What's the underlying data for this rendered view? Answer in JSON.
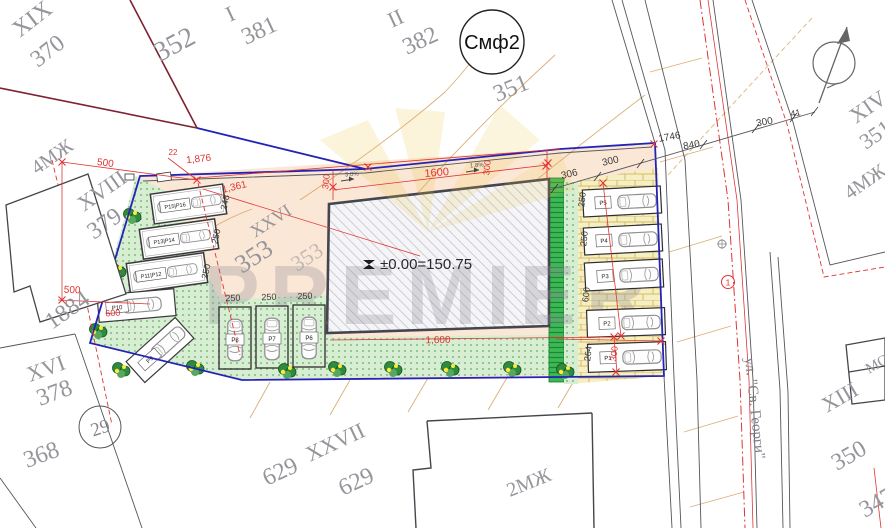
{
  "plan": {
    "building_elevation": "±0.00=150.75",
    "zone_circle": "Смф2",
    "point_circle": "29",
    "street_point": "1",
    "street_name": "ул. \"Св. Георги\"",
    "watermark": "PREMIER"
  },
  "colors": {
    "site_boundary": "#2323b8",
    "dim_red": "#e03434",
    "peach": "#fbe7d5",
    "green_light": "#d7eed2",
    "green_hedge": "#3cb954",
    "brick_bg": "#f6efc4",
    "watermark_gold": "#edc84a"
  },
  "parcel_labels": [
    {
      "t": "XIX",
      "x": 20,
      "y": 38,
      "r": -38,
      "s": 24
    },
    {
      "t": "370",
      "x": 38,
      "y": 68,
      "r": -38,
      "s": 24
    },
    {
      "t": "352",
      "x": 160,
      "y": 62,
      "r": -28,
      "s": 28
    },
    {
      "t": "I",
      "x": 230,
      "y": 22,
      "r": -25,
      "s": 22
    },
    {
      "t": "381",
      "x": 246,
      "y": 45,
      "r": -25,
      "s": 24
    },
    {
      "t": "II",
      "x": 392,
      "y": 28,
      "r": -25,
      "s": 22
    },
    {
      "t": "382",
      "x": 407,
      "y": 55,
      "r": -25,
      "s": 24
    },
    {
      "t": "351",
      "x": 497,
      "y": 102,
      "r": -22,
      "s": 24
    },
    {
      "t": "XIV",
      "x": 856,
      "y": 124,
      "r": -35,
      "s": 22
    },
    {
      "t": "351",
      "x": 866,
      "y": 150,
      "r": -35,
      "s": 22
    },
    {
      "t": "4МЖ",
      "x": 850,
      "y": 200,
      "r": -35,
      "s": 20
    },
    {
      "t": "4МЖ",
      "x": 37,
      "y": 175,
      "r": -35,
      "s": 20
    },
    {
      "t": "XVIII",
      "x": 84,
      "y": 212,
      "r": -35,
      "s": 22
    },
    {
      "t": "379",
      "x": 94,
      "y": 240,
      "r": -35,
      "s": 24
    },
    {
      "t": "1884",
      "x": 52,
      "y": 330,
      "r": -35,
      "s": 24
    },
    {
      "t": "XXVI",
      "x": 255,
      "y": 238,
      "r": -33,
      "s": 18
    },
    {
      "t": "353",
      "x": 242,
      "y": 274,
      "r": -33,
      "s": 26
    },
    {
      "t": "353",
      "x": 297,
      "y": 272,
      "r": -33,
      "s": 22,
      "op": 0.55
    },
    {
      "t": "XVI",
      "x": 30,
      "y": 382,
      "r": -20,
      "s": 22
    },
    {
      "t": "378",
      "x": 40,
      "y": 406,
      "r": -20,
      "s": 24
    },
    {
      "t": "368",
      "x": 27,
      "y": 468,
      "r": -20,
      "s": 24
    },
    {
      "t": "XXVII",
      "x": 310,
      "y": 462,
      "r": -25,
      "s": 22
    },
    {
      "t": "629",
      "x": 267,
      "y": 486,
      "r": -25,
      "s": 24
    },
    {
      "t": "629",
      "x": 343,
      "y": 496,
      "r": -25,
      "s": 24
    },
    {
      "t": "2МЖ",
      "x": 510,
      "y": 497,
      "r": -22,
      "s": 20
    },
    {
      "t": "XIII",
      "x": 827,
      "y": 413,
      "r": -30,
      "s": 22
    },
    {
      "t": "350",
      "x": 837,
      "y": 471,
      "r": -30,
      "s": 24
    },
    {
      "t": "347",
      "x": 865,
      "y": 518,
      "r": -30,
      "s": 24
    },
    {
      "t": "МО",
      "x": 869,
      "y": 374,
      "r": -30,
      "s": 15
    }
  ],
  "dimensions_red": [
    {
      "t": "500",
      "x": 105,
      "y": 166,
      "r": 7,
      "s": 10
    },
    {
      "t": "1,876",
      "x": 199,
      "y": 162,
      "r": -6,
      "s": 10
    },
    {
      "t": "1,361",
      "x": 235,
      "y": 190,
      "r": -14,
      "s": 10
    },
    {
      "t": "22",
      "x": 173,
      "y": 155,
      "r": 0,
      "s": 8
    },
    {
      "t": "500",
      "x": 72,
      "y": 293,
      "r": 3,
      "s": 10
    },
    {
      "t": "1600",
      "x": 437,
      "y": 176,
      "r": -5,
      "s": 11
    },
    {
      "t": "300",
      "x": 329,
      "y": 182,
      "r": -83,
      "s": 9
    },
    {
      "t": "300",
      "x": 490,
      "y": 168,
      "r": -83,
      "s": 9
    },
    {
      "t": "1,600",
      "x": 438,
      "y": 343,
      "r": -1,
      "s": 10
    },
    {
      "t": "300",
      "x": 617,
      "y": 354,
      "r": -83,
      "s": 9
    },
    {
      "t": "600",
      "x": 113,
      "y": 316,
      "r": -4,
      "s": 9
    }
  ],
  "dimensions_black": [
    {
      "t": "306",
      "x": 570,
      "y": 177,
      "r": -13,
      "s": 10
    },
    {
      "t": "300",
      "x": 611,
      "y": 164,
      "r": -13,
      "s": 10
    },
    {
      "t": "1746",
      "x": 670,
      "y": 140,
      "r": -10,
      "s": 10
    },
    {
      "t": "840",
      "x": 692,
      "y": 148,
      "r": -10,
      "s": 10
    },
    {
      "t": "300",
      "x": 765,
      "y": 125,
      "r": -10,
      "s": 10
    },
    {
      "t": "41",
      "x": 796,
      "y": 116,
      "r": -10,
      "s": 9
    },
    {
      "t": "248",
      "x": 228,
      "y": 203,
      "r": -78,
      "s": 9
    },
    {
      "t": "250",
      "x": 219,
      "y": 237,
      "r": -78,
      "s": 9
    },
    {
      "t": "250",
      "x": 209,
      "y": 272,
      "r": -78,
      "s": 9
    },
    {
      "t": "250",
      "x": 233,
      "y": 301,
      "r": -2,
      "s": 9
    },
    {
      "t": "250",
      "x": 269,
      "y": 300,
      "r": -2,
      "s": 9
    },
    {
      "t": "250",
      "x": 305,
      "y": 299,
      "r": -2,
      "s": 9
    },
    {
      "t": "250",
      "x": 585,
      "y": 200,
      "r": -83,
      "s": 9
    },
    {
      "t": "250",
      "x": 587,
      "y": 239,
      "r": -83,
      "s": 9
    },
    {
      "t": "600",
      "x": 589,
      "y": 295,
      "r": -83,
      "s": 9
    },
    {
      "t": "264",
      "x": 591,
      "y": 354,
      "r": -83,
      "s": 9
    }
  ],
  "slope_labels": [
    {
      "t": "3.0%",
      "x": 352,
      "y": 176,
      "r": -4,
      "s": 6
    },
    {
      "t": "1.8%",
      "x": 477,
      "y": 167,
      "r": -4,
      "s": 6
    }
  ],
  "parking": {
    "garages": [
      {
        "label": "P15|P16",
        "x": 152,
        "y": 189,
        "w": 73,
        "h": 30,
        "rot": -8
      },
      {
        "label": "P13|P14",
        "x": 141,
        "y": 224,
        "w": 76,
        "h": 30,
        "rot": -8
      },
      {
        "label": "P11|P12",
        "x": 128,
        "y": 258,
        "w": 78,
        "h": 30,
        "rot": -8
      }
    ],
    "open_stalls": [
      {
        "label": "P10",
        "x": 98,
        "y": 292,
        "w": 77,
        "h": 27,
        "rot": -5
      },
      {
        "label": "P9",
        "x": 127,
        "y": 336,
        "w": 66,
        "h": 28,
        "rot": -42
      }
    ],
    "vertical_stalls": [
      {
        "label": "P8",
        "x": 219,
        "y": 307,
        "w": 32,
        "h": 62
      },
      {
        "label": "P7",
        "x": 256,
        "y": 306,
        "w": 32,
        "h": 62
      },
      {
        "label": "P6",
        "x": 293,
        "y": 305,
        "w": 32,
        "h": 62
      }
    ],
    "street_stalls": [
      {
        "label": "P5",
        "x": 583,
        "y": 188,
        "w": 78,
        "h": 27,
        "rot": -3
      },
      {
        "label": "P4",
        "x": 584,
        "y": 226,
        "w": 78,
        "h": 27,
        "rot": -3
      },
      {
        "label": "P3",
        "x": 585,
        "y": 261,
        "w": 78,
        "h": 28,
        "rot": -3
      },
      {
        "label": "P2",
        "x": 587,
        "y": 309,
        "w": 78,
        "h": 27,
        "rot": -2
      },
      {
        "label": "P1",
        "x": 588,
        "y": 343,
        "w": 78,
        "h": 28,
        "rot": -2
      }
    ]
  },
  "trees": [
    [
      133,
      216
    ],
    [
      118,
      271
    ],
    [
      99,
      331
    ],
    [
      122,
      370
    ],
    [
      196,
      368
    ],
    [
      288,
      371
    ],
    [
      338,
      369
    ],
    [
      394,
      369
    ],
    [
      451,
      369
    ],
    [
      513,
      369
    ],
    [
      566,
      371
    ]
  ],
  "red_marks": [
    [
      62,
      162
    ],
    [
      62,
      300
    ],
    [
      197,
      180
    ],
    [
      368,
      167
    ],
    [
      548,
      163
    ],
    [
      654,
      144
    ],
    [
      333,
      187
    ],
    [
      546,
      166
    ],
    [
      603,
      183
    ],
    [
      621,
      336
    ],
    [
      661,
      341
    ],
    [
      614,
      337
    ],
    [
      616,
      372
    ]
  ]
}
